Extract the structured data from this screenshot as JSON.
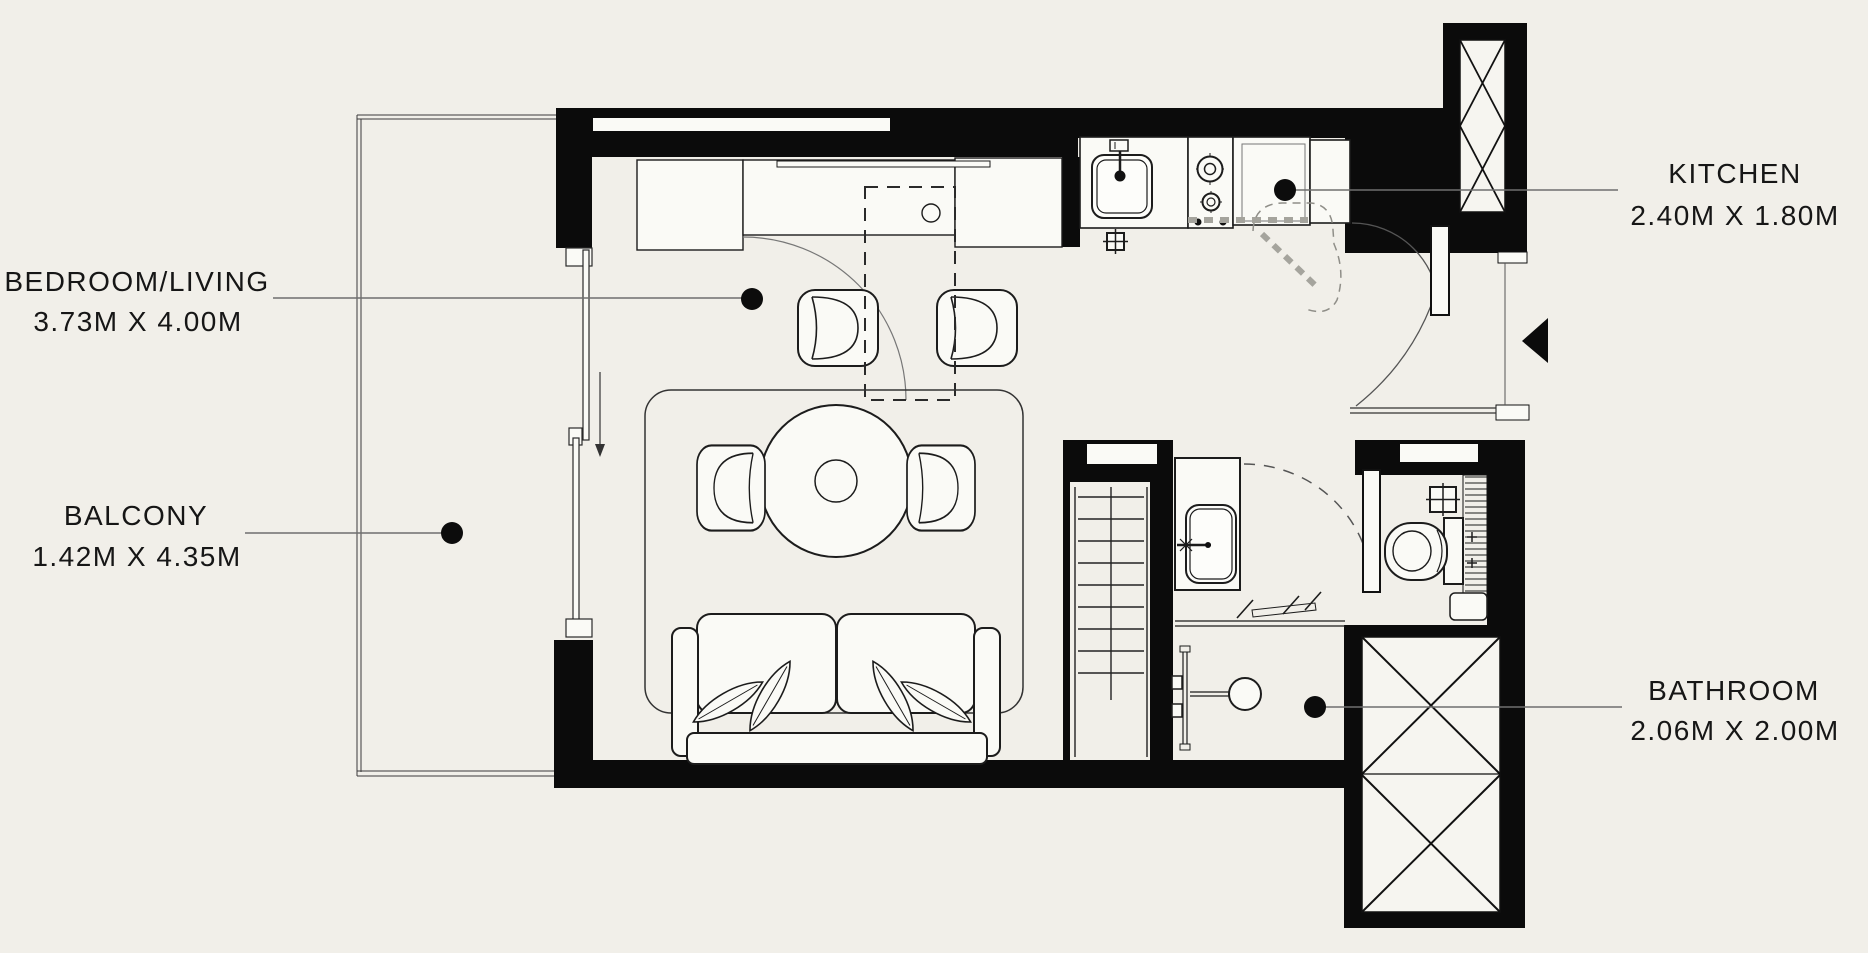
{
  "colors": {
    "background": "#f1efe9",
    "wall": "#0b0b0b",
    "line": "#1c1c1c",
    "leader": "#6f6f6f",
    "dashed_gray": "#a5a49d",
    "text": "#161616",
    "fixture_fill": "#fafaf6"
  },
  "labels": {
    "bedroom_living": {
      "name": "BEDROOM/LIVING",
      "dimensions": "3.73M X 4.00M"
    },
    "balcony": {
      "name": "BALCONY",
      "dimensions": "1.42M X 4.35M"
    },
    "kitchen": {
      "name": "KITCHEN",
      "dimensions": "2.40M X 1.80M"
    },
    "bathroom": {
      "name": "BATHROOM",
      "dimensions": "2.06M X 2.00M"
    }
  }
}
